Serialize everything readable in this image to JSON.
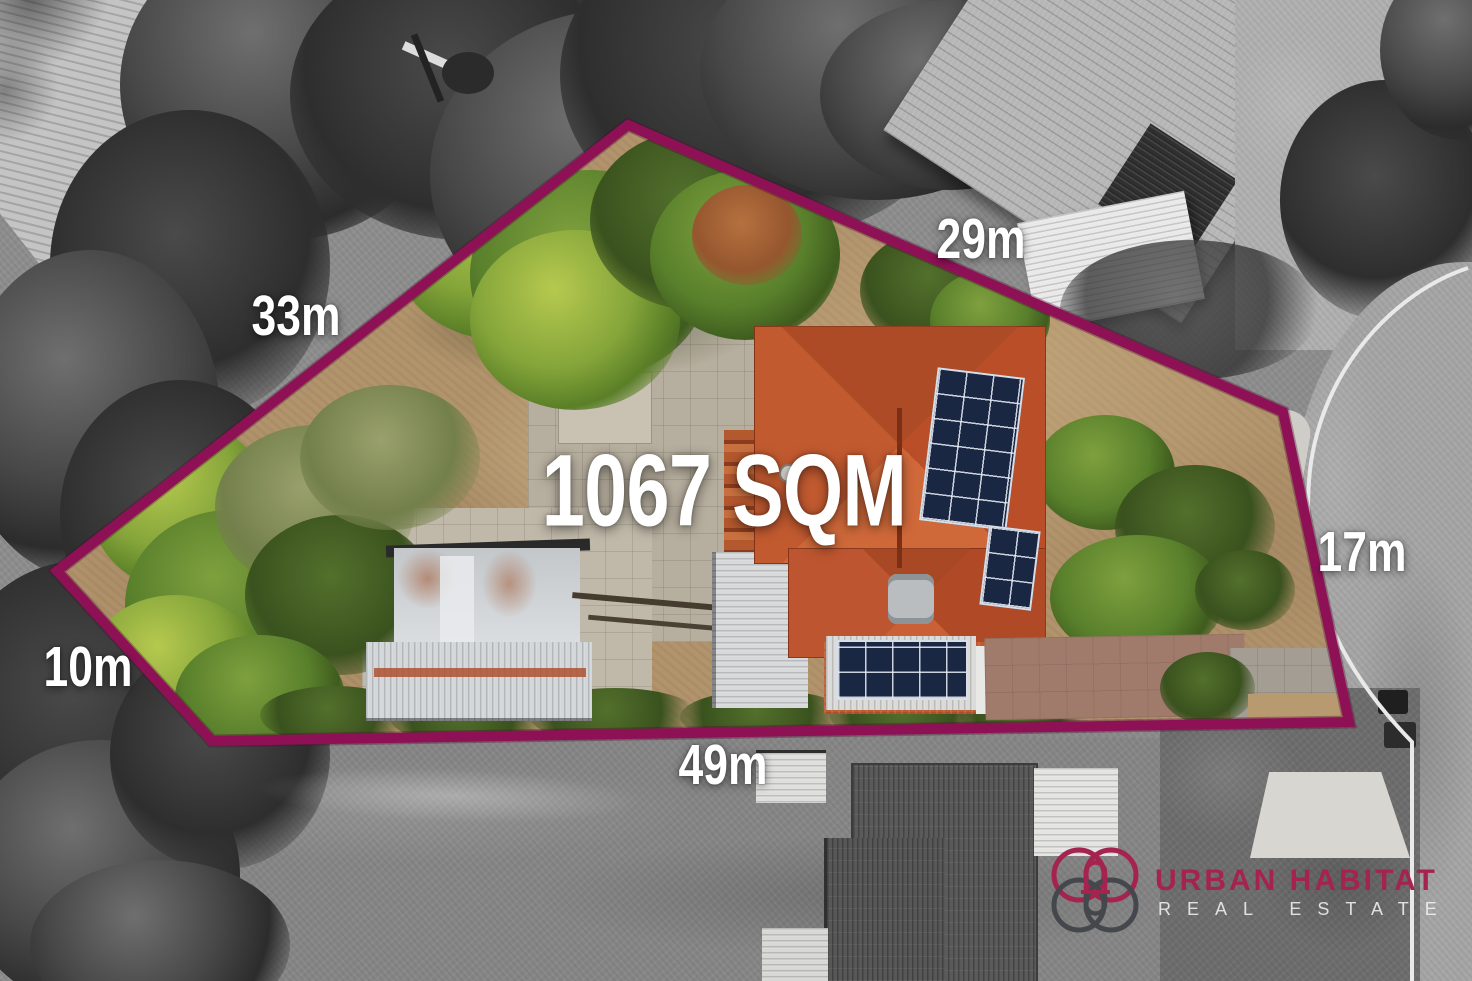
{
  "overlay": {
    "area_label": "1067 SQM",
    "boundary_color": "#8e1156",
    "dimensions": [
      {
        "side": "northwest",
        "label": "33m"
      },
      {
        "side": "northeast",
        "label": "29m"
      },
      {
        "side": "east",
        "label": "17m"
      },
      {
        "side": "southwest",
        "label": "10m"
      },
      {
        "side": "south",
        "label": "49m"
      }
    ]
  },
  "branding": {
    "name": "URBAN HABITAT",
    "tagline": "REAL ESTATE",
    "name_color": "#a5234f",
    "tagline_color": "#f2f2f2"
  }
}
